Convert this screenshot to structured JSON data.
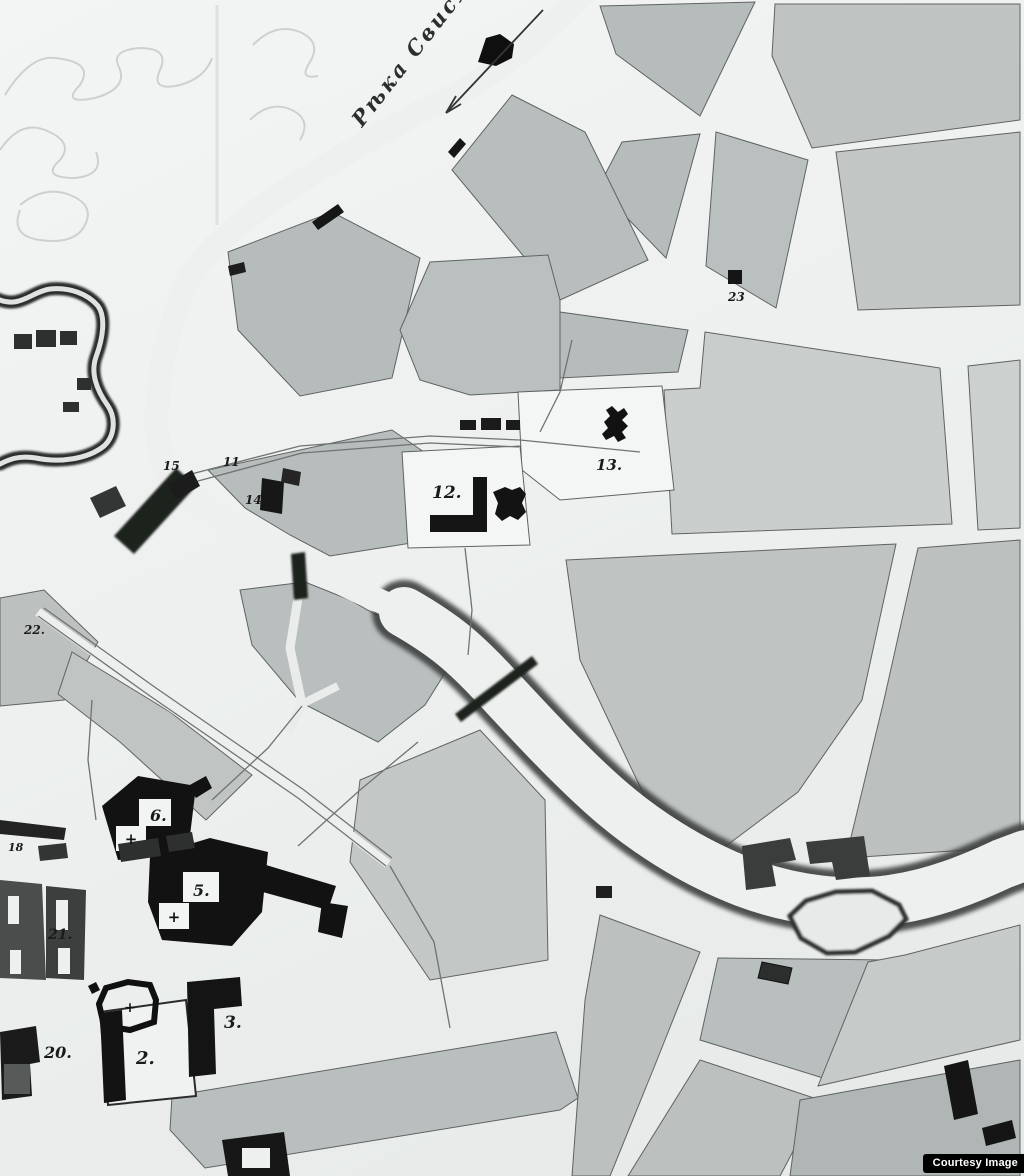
{
  "map": {
    "river_label": "Рѣка Свислочь",
    "plot_numbers": [
      "2.",
      "3.",
      "5.",
      "6.",
      "11",
      "12.",
      "13.",
      "14",
      "15",
      "18",
      "20.",
      "21.",
      "22.",
      "23"
    ],
    "church_marks": [
      "+",
      "+",
      "+"
    ],
    "watermark": "Courtesy Image",
    "colors": {
      "paper": "#eef0ef",
      "block_gray": "#b7bdbc",
      "ink_black": "#141514",
      "bank_dark": "#3c403f"
    }
  }
}
